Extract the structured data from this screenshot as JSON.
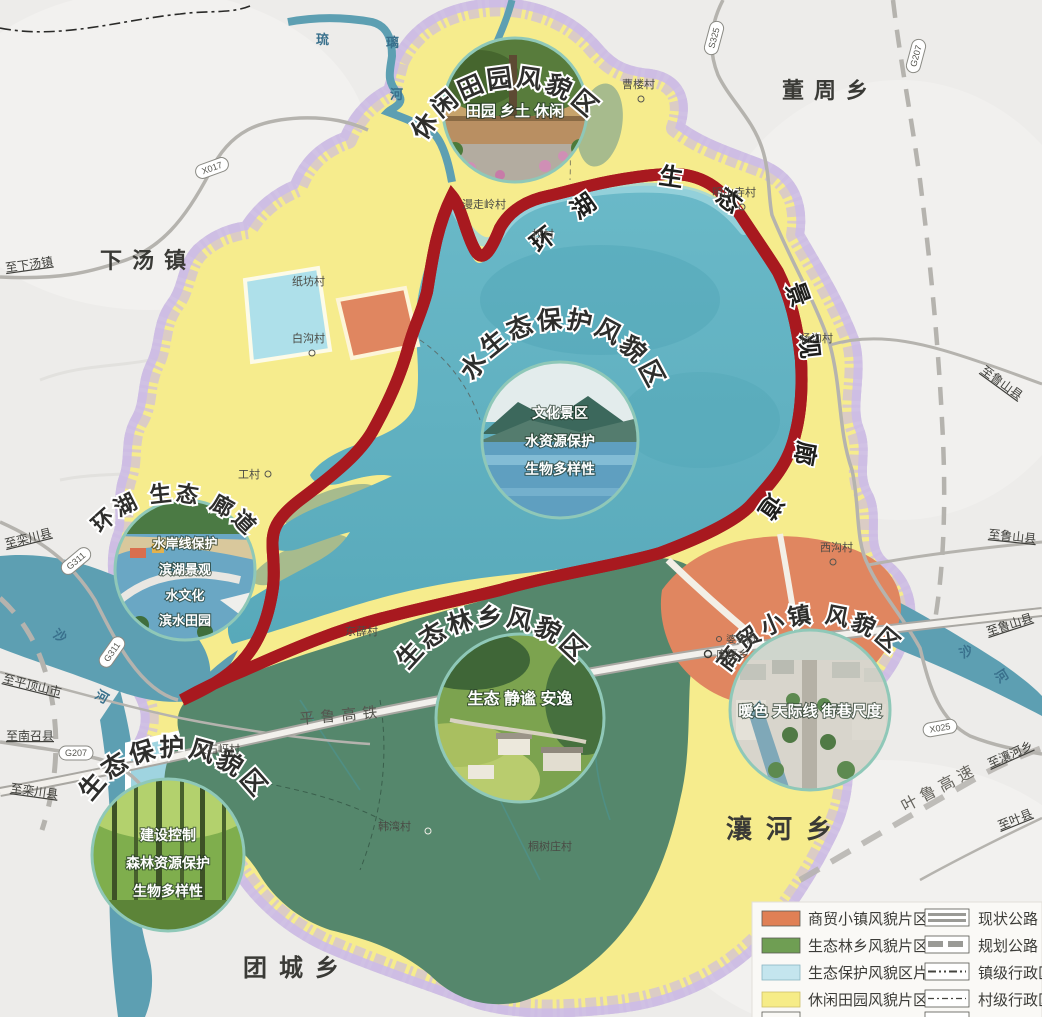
{
  "map": {
    "townships": [
      "下汤镇",
      "董周乡",
      "瀼河乡",
      "团城乡"
    ],
    "villages": [
      "曹楼村",
      "明山寺村",
      "漫走岭村",
      "权村",
      "纸坊村",
      "白沟村",
      "工村",
      "杨沟村",
      "西沟村",
      "婆娑街",
      "库区乡",
      "火石岈村",
      "东薛村",
      "韩湾村",
      "桐树庄村"
    ],
    "edge_labels": [
      "至下汤镇",
      "至栾川县",
      "至平顶山市",
      "至南召县",
      "至栾川县",
      "至鲁山县",
      "至鲁山县",
      "至鲁山县",
      "至瀼河乡",
      "至叶县"
    ],
    "road_badges": [
      "X017",
      "S325",
      "G207",
      "G311",
      "G311",
      "G207",
      "X025"
    ],
    "rivers": {
      "liuli": [
        "琉",
        "璃",
        "河"
      ],
      "sha": [
        "沙",
        "河"
      ]
    },
    "rail": "平鲁高铁",
    "expressway": "叶鲁高速"
  },
  "ring": {
    "c0": "环",
    "c1": "湖",
    "c2": "生",
    "c3": "态",
    "c4": "景",
    "c5": "观",
    "c6": "廊",
    "c7": "道"
  },
  "circles": [
    {
      "title": "休闲田园风貌区",
      "caption": "田园 乡土 休闲"
    },
    {
      "title": "水生态保护风貌区",
      "lines": [
        "文化景区",
        "水资源保护",
        "生物多样性"
      ]
    },
    {
      "title": "环湖 生态 廊道",
      "lines": [
        "水岸线保护",
        "滨湖景观",
        "水文化",
        "滨水田园"
      ]
    },
    {
      "title": "生态保护风貌区",
      "lines": [
        "建设控制",
        "森林资源保护",
        "生物多样性"
      ]
    },
    {
      "title": "生态林乡风貌区",
      "caption": "生态 静谧 安逸"
    },
    {
      "title": "商贸小镇 风貌区",
      "caption": "暖色 天际线 街巷尺度"
    }
  ],
  "legend": {
    "zones": [
      {
        "label": "商贸小镇风貌片区",
        "color": "#E08055"
      },
      {
        "label": "生态林乡风貌片区",
        "color": "#6F9E53"
      },
      {
        "label": "生态保护风貌区片",
        "color": "#C4E5EE"
      },
      {
        "label": "休闲田园风貌片区",
        "color": "#F6EC87"
      }
    ],
    "lines": [
      {
        "label": "现状公路"
      },
      {
        "label": "规划公路"
      },
      {
        "label": "镇级行政区"
      },
      {
        "label": "村级行政区"
      }
    ]
  },
  "colors": {
    "leisure_yellow": "#F6EC8D",
    "water_teal": "#62B3C2",
    "forest_green": "#55876C",
    "trade_orange": "#E08660",
    "protect_cyan": "#AEE0EA",
    "corridor_red": "#A8191F",
    "boundary_purple": "#B9A4D6",
    "river_blue": "#5D9FB2"
  }
}
